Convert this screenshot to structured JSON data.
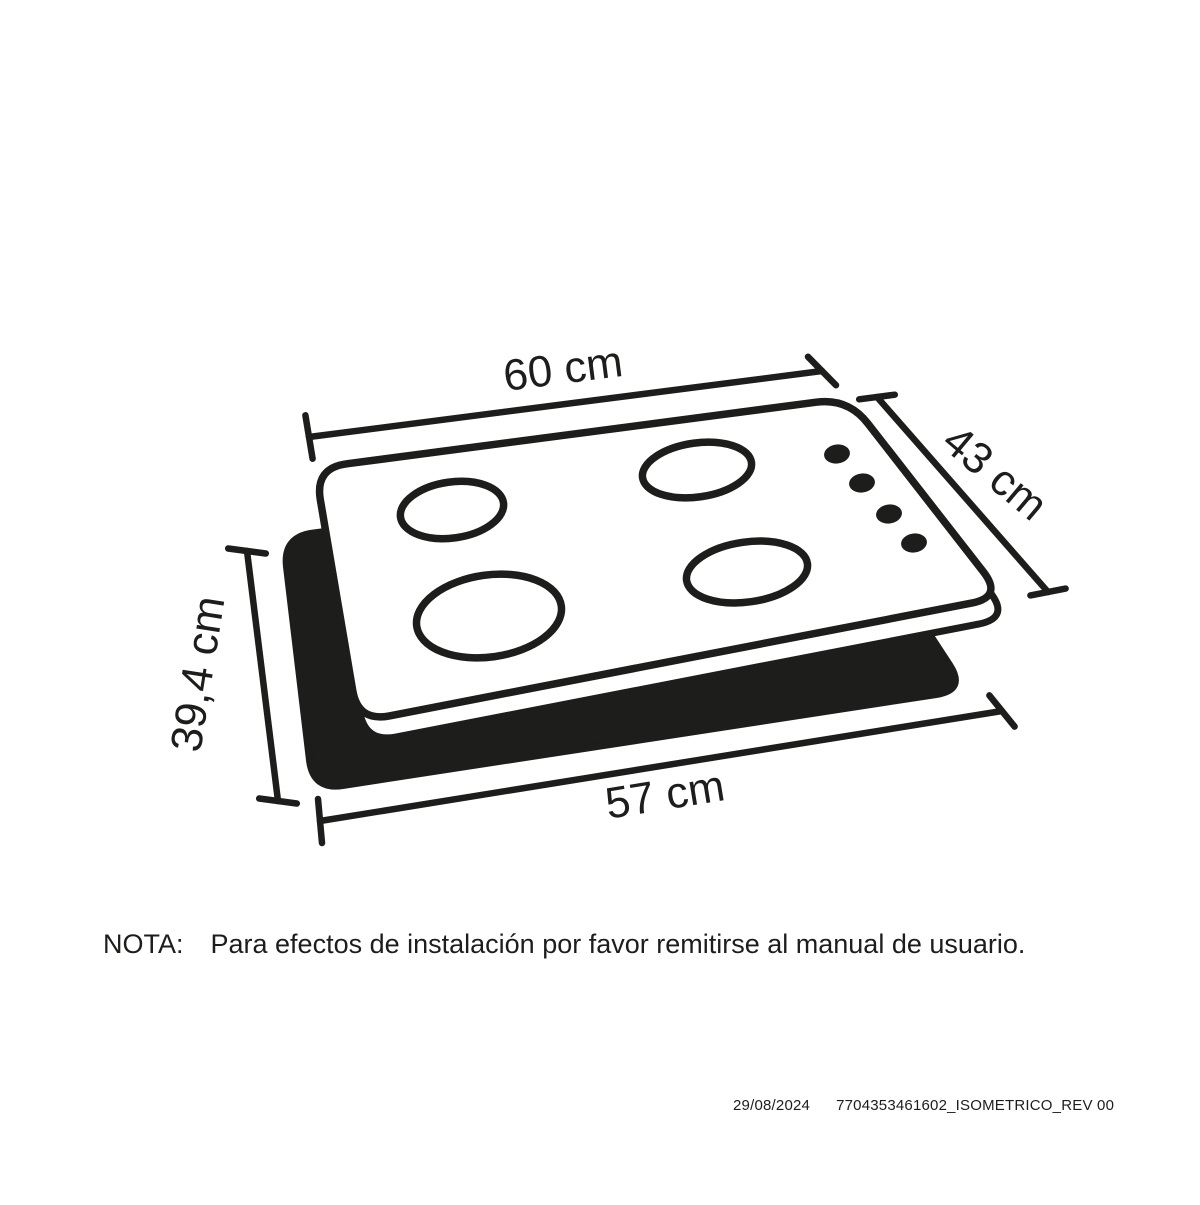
{
  "colors": {
    "ink": "#1d1d1b",
    "background": "#ffffff"
  },
  "diagram": {
    "dimensions": {
      "top_width": {
        "label": "60 cm",
        "value": 60,
        "unit": "cm"
      },
      "right_depth": {
        "label": "43 cm",
        "value": 43,
        "unit": "cm"
      },
      "left_height": {
        "label": "39,4 cm",
        "value": 39.4,
        "unit": "cm"
      },
      "bottom_width": {
        "label": "57 cm",
        "value": 57,
        "unit": "cm"
      }
    },
    "burner_count": 4,
    "knob_count": 4
  },
  "note": {
    "prefix": "NOTA:",
    "text": "Para efectos de instalación por favor remitirse al manual de usuario."
  },
  "footer": {
    "date": "29/08/2024",
    "document_code": "7704353461602_ISOMETRICO_REV 00"
  }
}
